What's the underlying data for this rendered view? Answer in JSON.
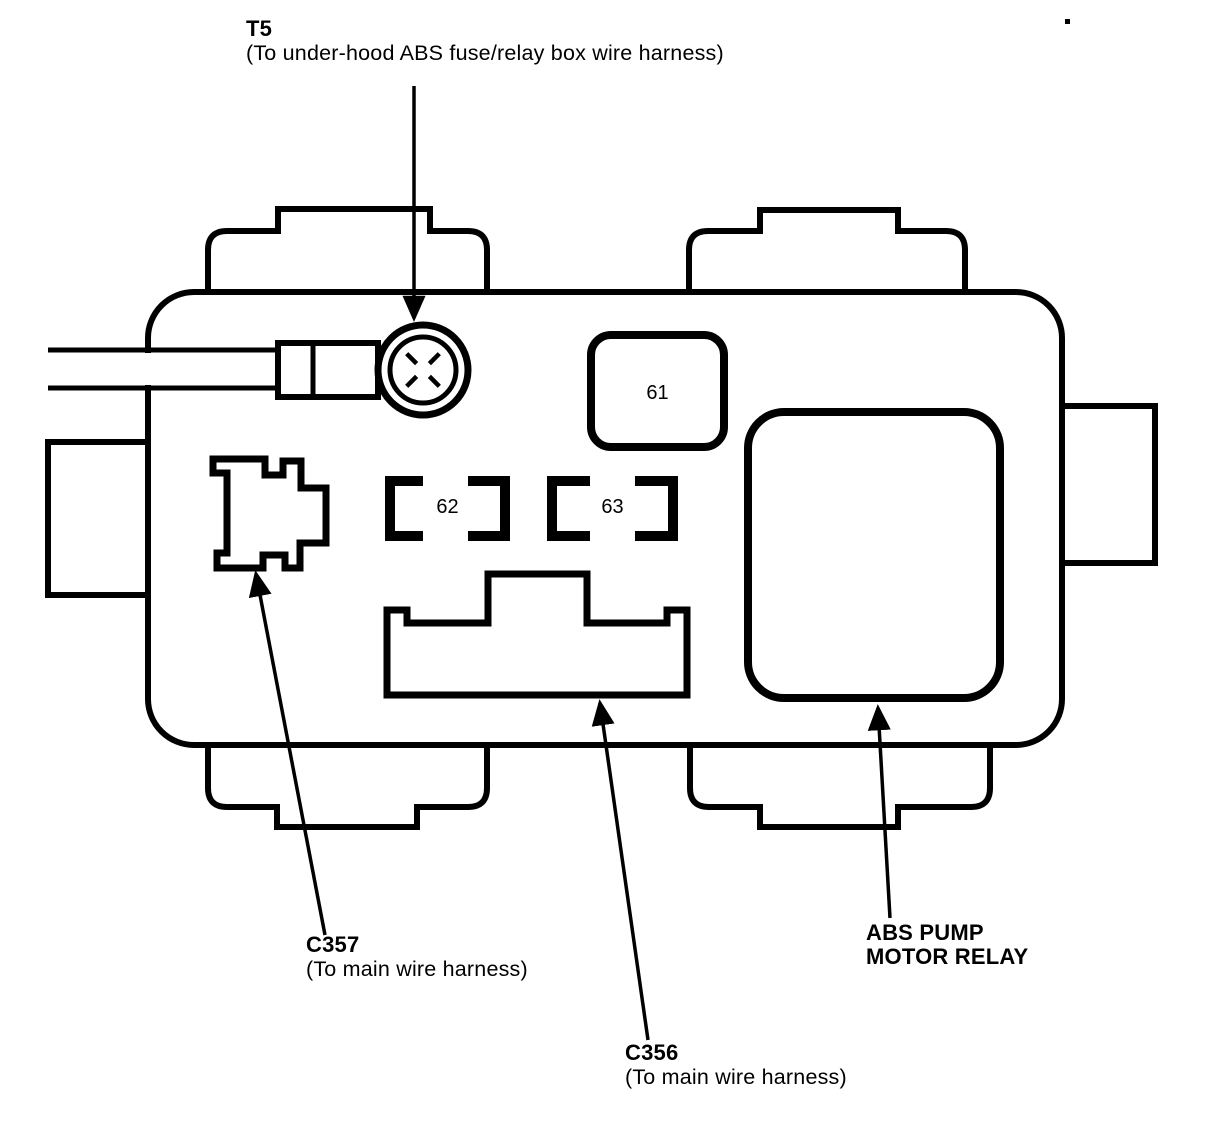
{
  "callouts": {
    "t5": {
      "id": "T5",
      "desc": "(To under-hood ABS fuse/relay box wire harness)"
    },
    "c357": {
      "id": "C357",
      "desc": "(To main wire harness)"
    },
    "c356": {
      "id": "C356",
      "desc": "(To main wire harness)"
    },
    "abs_pump_motor_relay": {
      "line1": "ABS PUMP",
      "line2": "MOTOR RELAY"
    }
  },
  "slots": {
    "s61": "61",
    "s62": "62",
    "s63": "63"
  },
  "colors": {
    "ink": "#000000",
    "paper": "#ffffff"
  }
}
